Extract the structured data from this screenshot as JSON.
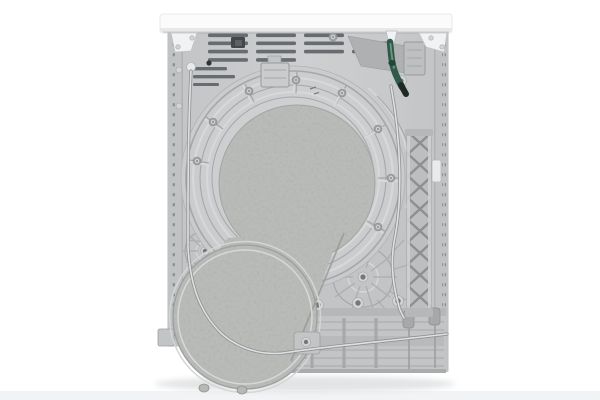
{
  "photo": {
    "subject": "appliance-rear-panel-photo",
    "colors": {
      "background": "#ffffff",
      "floor_band": "#f2f3f4",
      "shadow": "#e3e4e5",
      "top_panel": "#fbfbfc",
      "top_panel_edge": "#e7e8e9",
      "top_panel_line": "#d0d2d3",
      "body_a": "#c3c5c7",
      "body_b": "#cdcfd1",
      "body_edge": "#a9abad",
      "strip": "#c0c2c4",
      "strip_line": "#b0b2b4",
      "dot": "#8d8f91",
      "vent_slot": "#686b6f",
      "clip_dark": "#44474a",
      "clip_inner": "#5d6064",
      "platform_a": "#d3d5d7",
      "platform_b": "#c7c9cb",
      "rib_light": "#d7d8d9",
      "rib_dark": "#a5a7a9",
      "speckle_base": "#b9bbb8",
      "speckle_edge": "#9a9c9a",
      "plate": "#c2c4c6",
      "hub_line": "#aeb0b2",
      "lattice": "#bcbec0",
      "lattice_line": "#8d8f91",
      "lattice_rail": "#d0d2d3",
      "tab_white": "#e9eaeb",
      "bracket_white": "#f1f2f3",
      "hose_green": "#2f5a49",
      "hose_highlight": "#6e9683",
      "hose_tip": "#1f2a25",
      "cable_light": "#dfe0e1",
      "cable_dark": "#8f9193",
      "screw_light": "#d2d4d5",
      "screw_dark": "#75777a",
      "grommet": "#a6a8aa",
      "bottom_band": "#b5b7b9",
      "bottom_deep": "#b8babc",
      "bottom_edge": "#a9abad",
      "recess": "#aeb0b2",
      "box": "#bdbfc1"
    }
  }
}
